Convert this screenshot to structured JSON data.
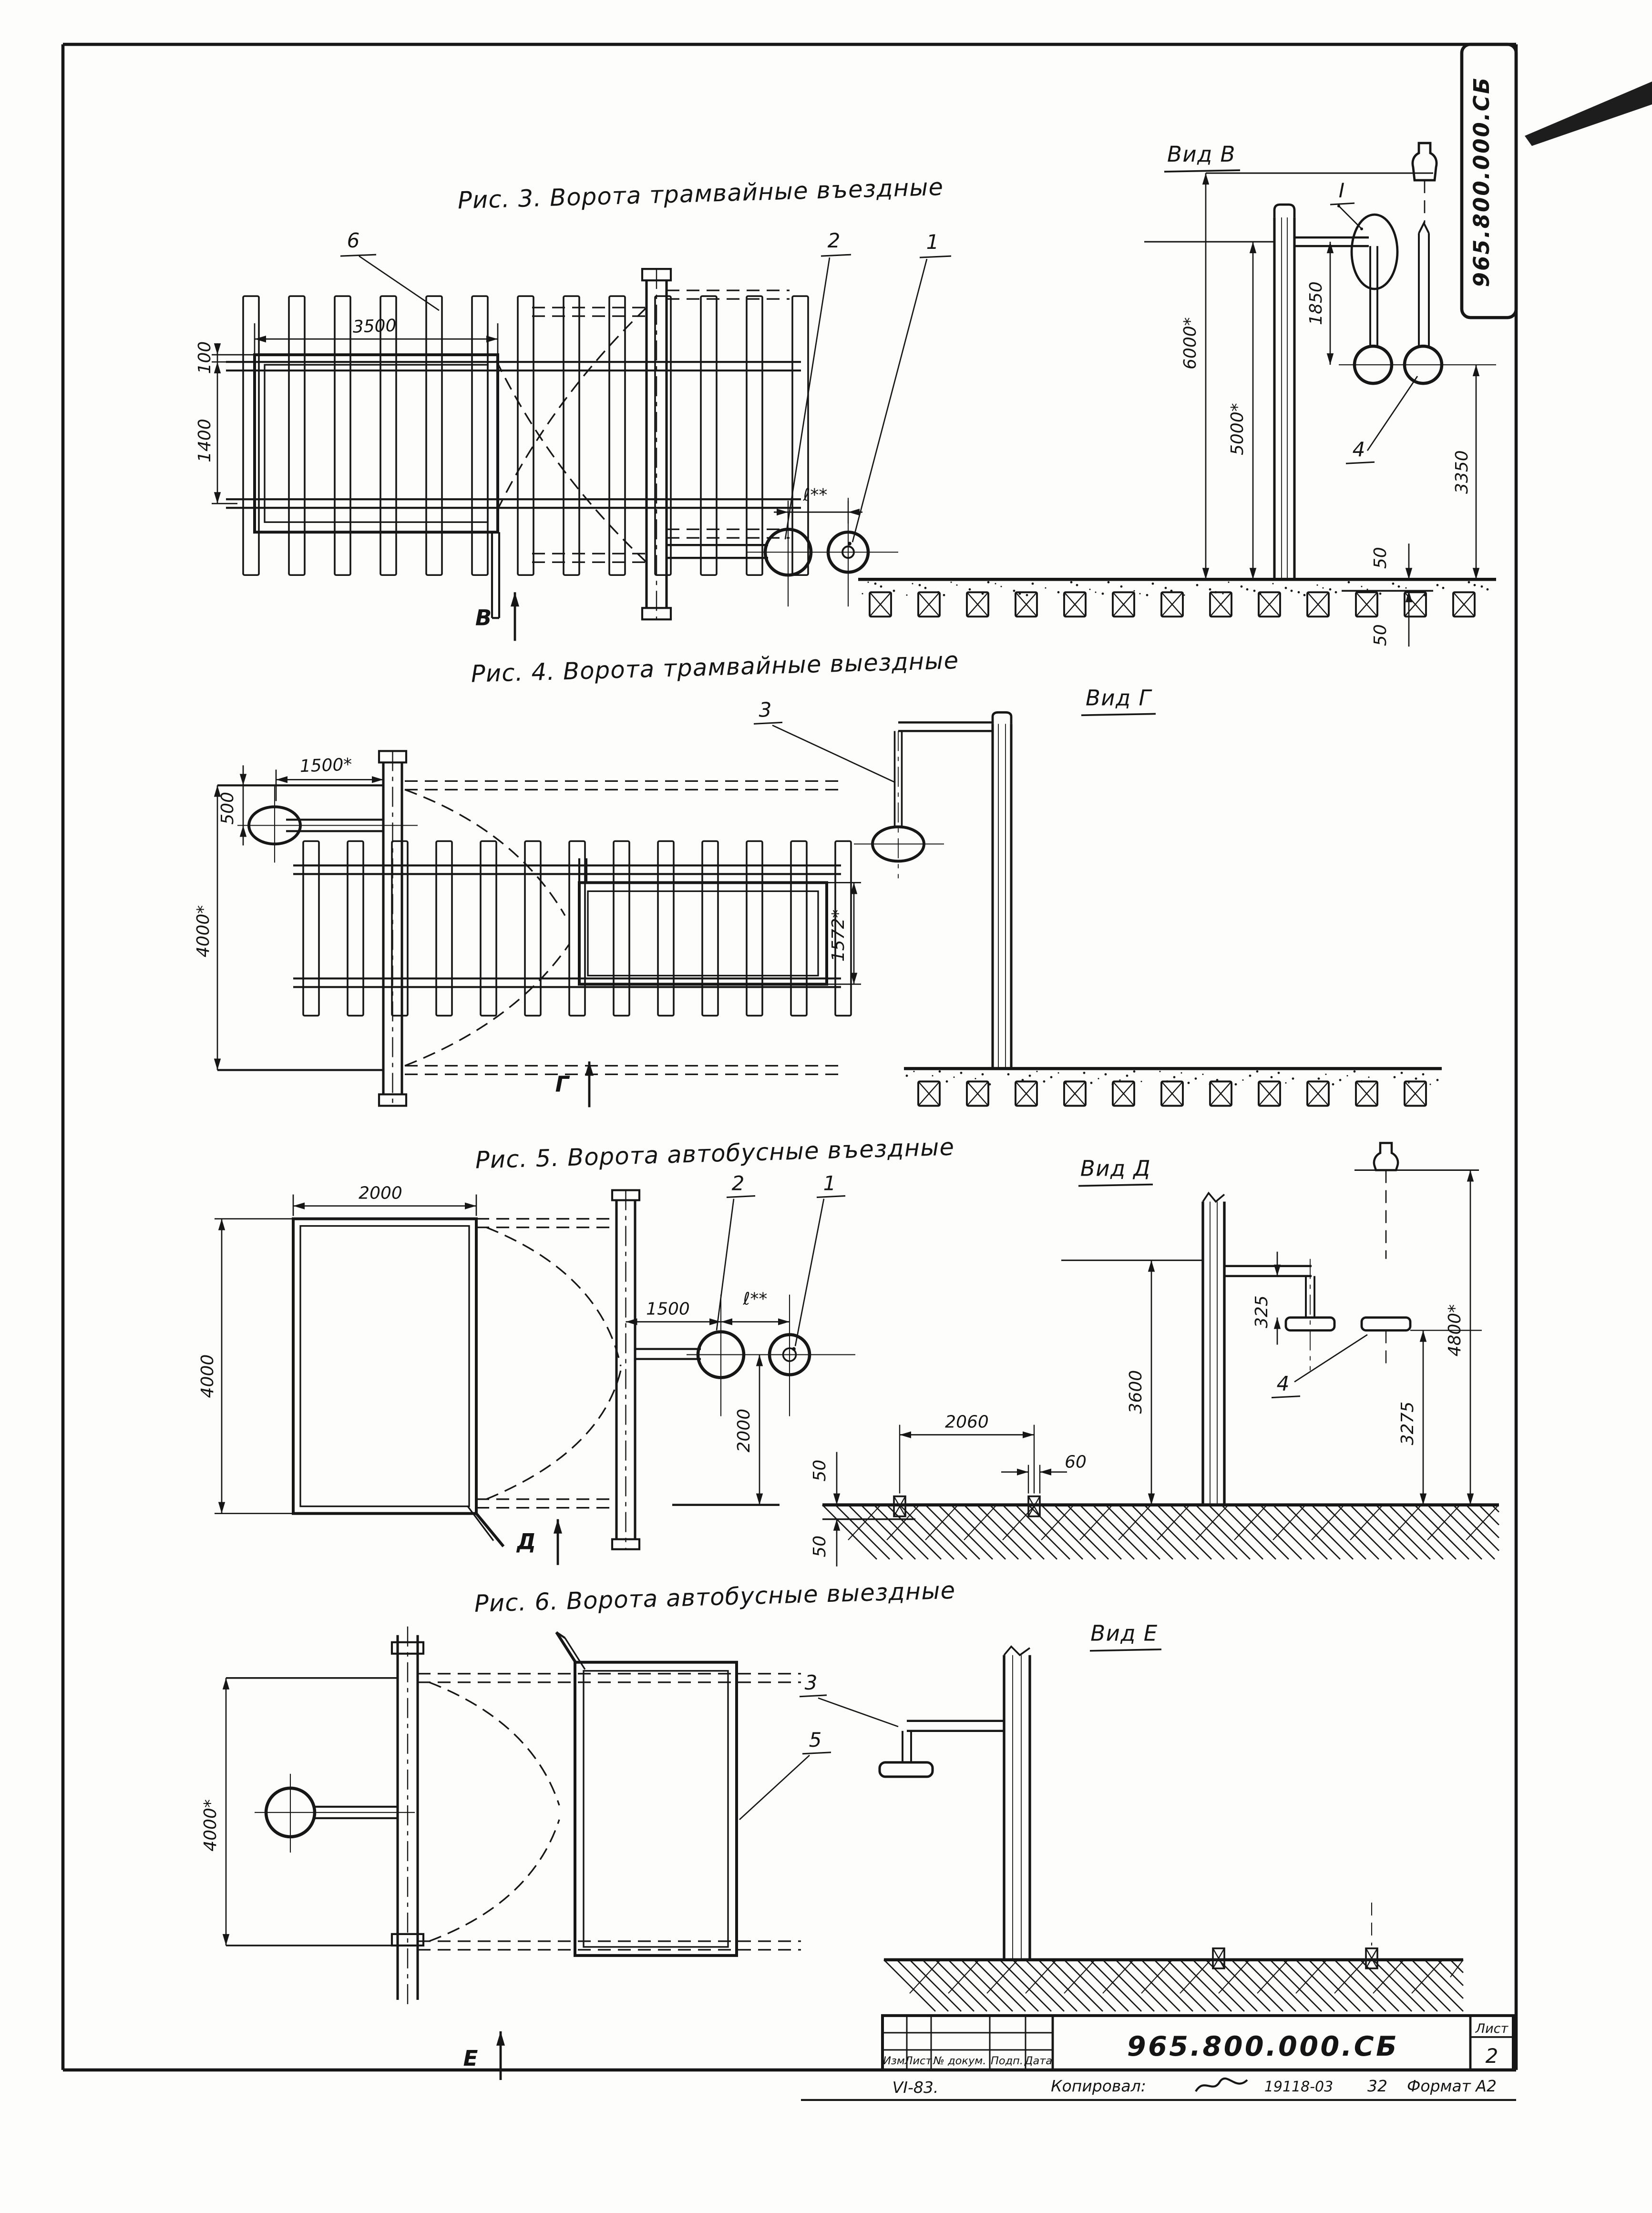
{
  "sheet": {
    "corner_stamp": "965.800.000.СБ",
    "title_block": {
      "doc_number": "965.800.000.СБ",
      "sheet_label": "Лист",
      "sheet_number": "2",
      "revision_headers": [
        "Изм",
        "Лист",
        "№ докум.",
        "Подп.",
        "Дата"
      ],
      "footer_left": "VI-83.",
      "copied_label": "Копировал:",
      "copy_ref": "19118-03",
      "copy_num": "32",
      "format_label": "Формат А2"
    }
  },
  "figures": {
    "fig3": {
      "title": "Рис. 3. Ворота трамвайные въездные",
      "view_label": "Вид В",
      "section_letter": "В",
      "callout_6": "6",
      "callout_2": "2",
      "callout_1": "1",
      "callout_I": "I",
      "callout_4": "4",
      "dim_3500": "3500",
      "dim_100": "100",
      "dim_1400": "1400",
      "dim_l": "ℓ**",
      "dim_6000": "6000*",
      "dim_5000": "5000*",
      "dim_1850": "1850",
      "dim_3350": "3350",
      "dim_50_top": "50",
      "dim_50_bottom": "50"
    },
    "fig4": {
      "title": "Рис. 4. Ворота трамвайные выездные",
      "view_label": "Вид Г",
      "section_letter": "Г",
      "callout_3": "3",
      "dim_1500": "1500*",
      "dim_500": "500",
      "dim_4000": "4000*",
      "dim_1572": "1572*"
    },
    "fig5": {
      "title": "Рис. 5. Ворота автобусные въездные",
      "view_label": "Вид Д",
      "section_letter": "Д",
      "callout_2": "2",
      "callout_1": "1",
      "callout_4": "4",
      "dim_2000_width": "2000",
      "dim_4000": "4000",
      "dim_1500": "1500",
      "dim_l": "ℓ**",
      "dim_2000_height": "2000",
      "dim_2060": "2060",
      "dim_50_top": "50",
      "dim_50_bottom": "50",
      "dim_60": "60",
      "dim_3600": "3600",
      "dim_325": "325",
      "dim_3275": "3275",
      "dim_4800": "4800*"
    },
    "fig6": {
      "title": "Рис. 6. Ворота автобусные выездные",
      "view_label": "Вид Е",
      "section_letter": "Е",
      "callout_3": "3",
      "callout_5": "5",
      "dim_4000": "4000*"
    }
  }
}
